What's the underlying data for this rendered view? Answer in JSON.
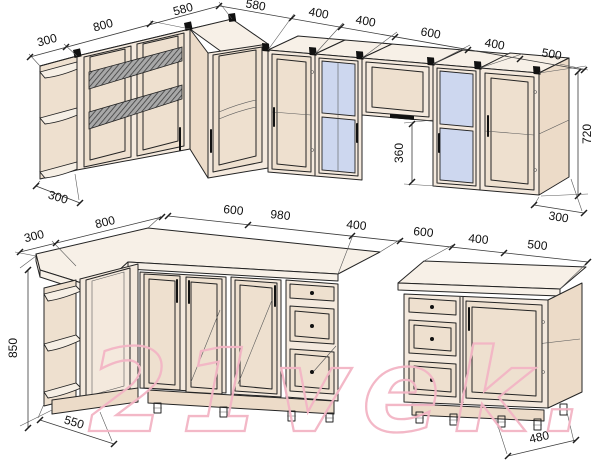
{
  "watermark": "21vek.by",
  "colors": {
    "cabinet_face": "#f4e9dd",
    "cabinet_side": "#ecdbc8",
    "cabinet_top": "#f7f0e7",
    "glass_blue": "#cdd7ef",
    "outline": "#242424",
    "dimension_line": "#3a3a3a",
    "watermark_pink": "#f3b5c5"
  },
  "dims": {
    "upper": {
      "left_line": [
        "300",
        "800",
        "580"
      ],
      "run_line": [
        "580",
        "400",
        "400",
        "600",
        "400",
        "500"
      ],
      "flip_clearance": "360",
      "height": "720",
      "left_depth": "300",
      "right_depth": "300"
    },
    "lower": {
      "left_line": [
        "300",
        "800"
      ],
      "run_line": [
        "600",
        "980",
        "400",
        "600",
        "400",
        "500"
      ],
      "height": "850",
      "left_depth": "550",
      "right_depth": "480"
    }
  }
}
